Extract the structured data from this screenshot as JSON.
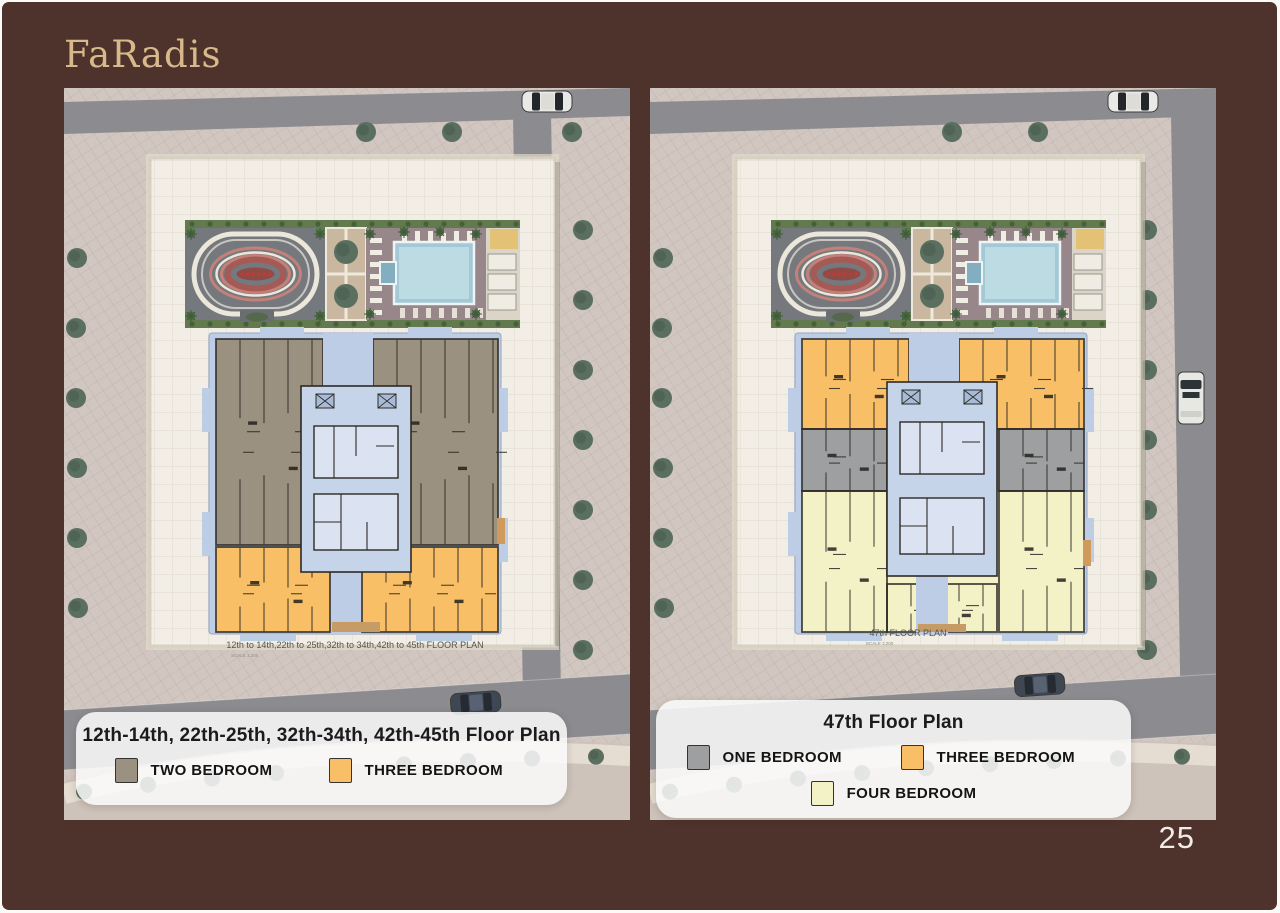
{
  "brand": {
    "name": "FaRadis"
  },
  "page_number": "25",
  "colors": {
    "background": "#4e332c",
    "logo_gold": "#d8b98b",
    "page_number_text": "#f2ece6",
    "legend_card_bg": "rgba(252,252,251,0.85)",
    "legend_text": "#1b1b1d",
    "two_bedroom": "#9a9180",
    "three_bedroom": "#f9bf67",
    "one_bedroom": "#9d9fa1",
    "four_bedroom": "#f3f1c6"
  },
  "site_palette": {
    "plaza": "#d1c7c0",
    "road": "#8c8c90",
    "sidewalk": "#cdc3ba",
    "podium": "#f2eee6",
    "tower_blue": "#bdcde5",
    "tree": "#5a6f60",
    "track_red": "#a65a55",
    "pool_blue": "#a3c8d6",
    "wall_line": "#2d2a25",
    "tan_balcony": "#c79b66"
  },
  "icons": {
    "car": "svg-shape",
    "van": "svg-shape",
    "tree": "svg-shape",
    "palm": "svg-shape",
    "running-track": "svg-shape",
    "swimming-pool": "svg-shape"
  },
  "panels": [
    {
      "id": "left",
      "plan_caption": "12th to 14th,22th to 25th,32th to 34th,42th to 45th FLOOR PLAN",
      "plan_scale": "SCALE 1:200",
      "card": {
        "title": "12th-14th, 22th-25th, 32th-34th, 42th-45th Floor Plan",
        "legend": [
          {
            "label": "TWO BEDROOM",
            "color_key": "two_bedroom"
          },
          {
            "label": "THREE BEDROOM",
            "color_key": "three_bedroom"
          }
        ]
      }
    },
    {
      "id": "right",
      "plan_caption": "47th FLOOR PLAN",
      "plan_scale": "SCALE 1:200",
      "card": {
        "title": "47th Floor Plan",
        "legend": [
          {
            "label": "ONE BEDROOM",
            "color_key": "one_bedroom"
          },
          {
            "label": "THREE BEDROOM",
            "color_key": "three_bedroom"
          },
          {
            "label": "FOUR BEDROOM",
            "color_key": "four_bedroom"
          }
        ]
      }
    }
  ]
}
